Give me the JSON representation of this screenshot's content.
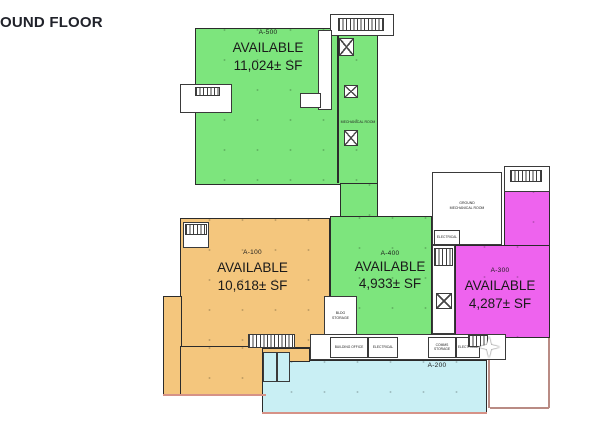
{
  "title": "OUND FLOOR",
  "plan": {
    "wall_color": "#2b2b2b",
    "units": [
      {
        "code": "A-500",
        "status": "AVAILABLE",
        "area": "11,024± SF",
        "color": "#7de57d"
      },
      {
        "code": "A-100",
        "status": "AVAILABLE",
        "area": "10,618± SF",
        "color": "#f4c67d"
      },
      {
        "code": "A-400",
        "status": "AVAILABLE",
        "area": "4,933± SF",
        "color": "#7de57d"
      },
      {
        "code": "A-300",
        "status": "AVAILABLE",
        "area": "4,287± SF",
        "color": "#ee63ee"
      },
      {
        "code": "A-200",
        "status": "",
        "area": "",
        "color": "#c9eff4"
      }
    ],
    "rooms": {
      "mechanical": "MECHANICAL ROOM",
      "ground_mech_1": "GROUND",
      "ground_mech_2": "MECHANICAL ROOM",
      "electrical_a": "ELECTRICAL",
      "building_office": "BUILDING OFFICE",
      "electrical_b": "ELECTRICAL",
      "comms_storage": "COMMS STORAGE",
      "electrical_c": "ELECTRICAL",
      "storage_1": "BLDG",
      "storage_2": "STORAGE"
    }
  }
}
